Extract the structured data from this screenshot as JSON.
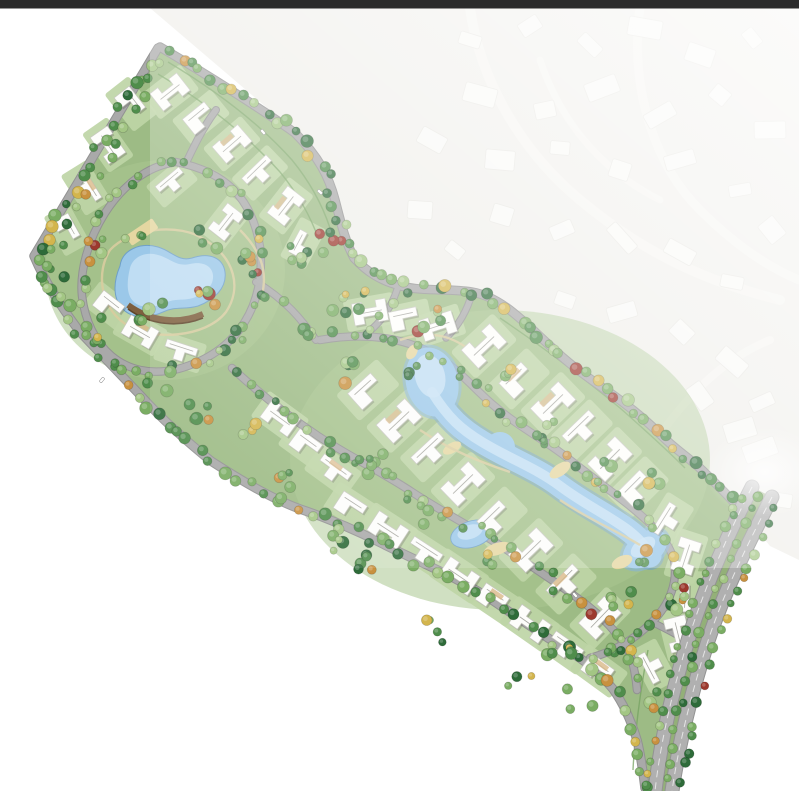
{
  "window": {
    "top_bar_color": "#2b2b2b",
    "background": "#ffffff"
  },
  "map": {
    "kind": "residential-masterplan-site-plan",
    "features": [
      "ghost-context-neighborhood",
      "site-parcel",
      "perimeter-road",
      "internal-loop-roads",
      "left-lake",
      "central-serpentine-lake",
      "small-pond",
      "sand-beaches",
      "wood-deck",
      "villa-buildings",
      "street-trees",
      "highway"
    ],
    "palette": {
      "bg": "#ffffff",
      "topbar": "#2b2b2b",
      "ghost_base": "#f0efeb",
      "ghost_house": "#f9f9f6",
      "ghost_house_edge": "#e7e6e1",
      "ghost_street": "#f5f4f0",
      "site_green": "#9dbb85",
      "site_edge": "#7fa468",
      "lawn": "#bed5a6",
      "lawn2": "#aac78f",
      "road": "#a9a9a9",
      "road_edge": "#929292",
      "hedge": "#76a161",
      "water_deep": "#86b4da",
      "water": "#9bc8e9",
      "water_light": "#c8e2f5",
      "water_rim": "#6fa0c8",
      "sand": "#e5d7a1",
      "sandpath": "#d8cc9e",
      "deck": "#7e5f3e",
      "deck_dark": "#5f452a",
      "tree_dark": "#2e6b39",
      "tree_mid": "#4f8d4b",
      "tree_light": "#7aad63",
      "tree_pale": "#a3c684",
      "tree_orange": "#c8913f",
      "tree_red": "#9c392e",
      "tree_yellow": "#d3b54d",
      "bld": "#fdfdfb",
      "bld_stroke": "#c7c7c0",
      "bld_shadow": "rgba(90,90,85,0.32)",
      "ridge": "#a8a8a2",
      "roof_tan": "#d9b98a",
      "hw": "#b0b0b0",
      "hw_line": "#e5e5e5",
      "median": "#93b078"
    }
  }
}
